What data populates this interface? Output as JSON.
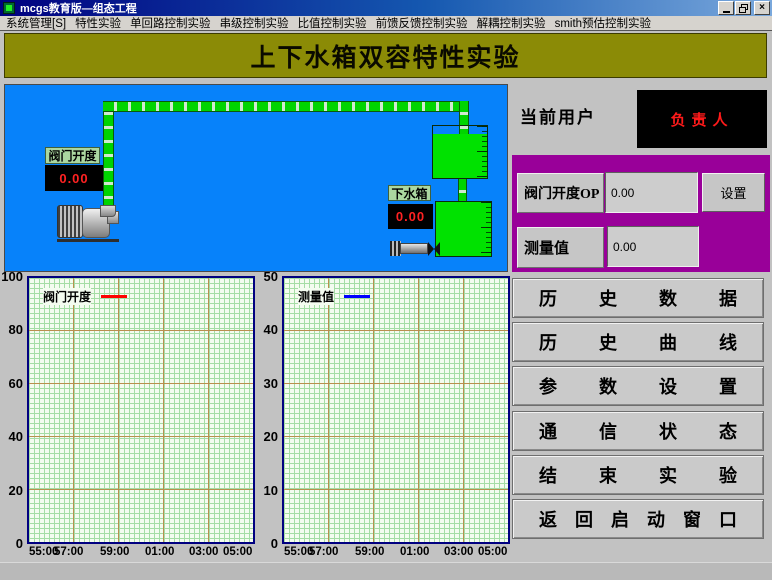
{
  "window": {
    "title": "mcgs教育版—组态工程",
    "minimize_glyph": "_",
    "close_glyph": "×"
  },
  "menu_bar": {
    "items": [
      "系统管理[S]",
      "特性实验",
      "单回路控制实验",
      "串级控制实验",
      "比值控制实验",
      "前馈反馈控制实验",
      "解耦控制实验",
      "smith预估控制实验"
    ]
  },
  "banner": {
    "title": "上下水箱双容特性实验"
  },
  "diagram": {
    "background_color": "#0782fa",
    "pipe_color": "#00d400",
    "tank_color": "#00e200",
    "valve_tag": "阀门开度",
    "valve_value": "0.00",
    "lower_tank_tag": "下水箱",
    "lower_tank_value": "0.00",
    "value_color": "#ff2222"
  },
  "user_panel": {
    "label": "当前用户",
    "value": "负责人",
    "value_color": "#ff1a1a"
  },
  "control_panel": {
    "background_color": "#990099",
    "op_label": "阀门开度OP",
    "op_value": "0.00",
    "set_button": "设置",
    "pv_label": "测量值",
    "pv_value": "0.00"
  },
  "charts": [
    {
      "legend": "阀门开度",
      "line_color": "#ff0000",
      "yticks": [
        "100",
        "80",
        "60",
        "40",
        "20",
        "0"
      ],
      "xticks": [
        "55:00",
        "57:00",
        "59:00",
        "01:00",
        "03:00",
        "05:00"
      ]
    },
    {
      "legend": "测量值",
      "line_color": "#0000ff",
      "yticks": [
        "50",
        "40",
        "30",
        "20",
        "10",
        "0"
      ],
      "xticks": [
        "55:00",
        "57:00",
        "59:00",
        "01:00",
        "03:00",
        "05:00"
      ]
    }
  ],
  "chart_data": [
    {
      "type": "line",
      "title": "",
      "ylim": [
        0,
        100
      ],
      "x_tick_labels": [
        "55:00",
        "57:00",
        "59:00",
        "01:00",
        "03:00",
        "05:00"
      ],
      "series": [
        {
          "name": "阀门开度",
          "color": "#ff0000",
          "x": [],
          "y": []
        }
      ],
      "grid": true,
      "legend_position": "top-left",
      "note_visible_data": "no curve plotted, value 0.00"
    },
    {
      "type": "line",
      "title": "",
      "ylim": [
        0,
        50
      ],
      "x_tick_labels": [
        "55:00",
        "57:00",
        "59:00",
        "01:00",
        "03:00",
        "05:00"
      ],
      "series": [
        {
          "name": "测量值",
          "color": "#0000ff",
          "x": [],
          "y": []
        }
      ],
      "grid": true,
      "legend_position": "top-left",
      "note_visible_data": "no curve plotted, value 0.00"
    }
  ],
  "action_buttons": [
    "历史数据",
    "历史曲线",
    "参数设置",
    "通信状态",
    "结束实验",
    "返回启动窗口"
  ]
}
